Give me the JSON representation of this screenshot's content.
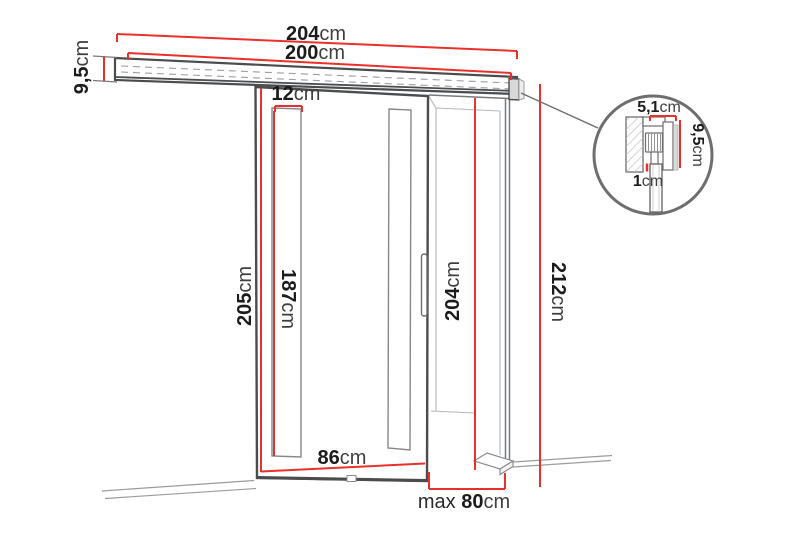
{
  "page": {
    "background": "#ffffff",
    "description_label": "sliding-door-dimension-diagram"
  },
  "colors": {
    "dimension_red": "#e8312a",
    "outline_dark": "#4a4c4e",
    "outline_mid": "#77797b",
    "outline_light": "#b4b6b8",
    "floor_gray": "#9a9c9e",
    "text_number": "#1c1c1c",
    "text_unit": "#3f3f3f"
  },
  "dimensions": {
    "track_total": {
      "value": "204",
      "unit": "cm"
    },
    "track_inner": {
      "value": "200",
      "unit": "cm"
    },
    "rail_height": {
      "value": "9,5",
      "unit": "cm"
    },
    "glass_strip_width": {
      "value": "12",
      "unit": "cm"
    },
    "door_height": {
      "value": "205",
      "unit": "cm"
    },
    "glass_strip_height": {
      "value": "187",
      "unit": "cm"
    },
    "opening_height": {
      "value": "204",
      "unit": "cm"
    },
    "total_height": {
      "value": "212",
      "unit": "cm"
    },
    "door_width": {
      "value": "86",
      "unit": "cm"
    },
    "max_opening_width": {
      "prefix": "max ",
      "value": "80",
      "unit": "cm"
    },
    "detail_profile_width": {
      "value": "5,1",
      "unit": "cm"
    },
    "detail_profile_height": {
      "value": "9,5",
      "unit": "cm"
    },
    "detail_floor_gap": {
      "value": "1",
      "unit": "cm"
    }
  }
}
